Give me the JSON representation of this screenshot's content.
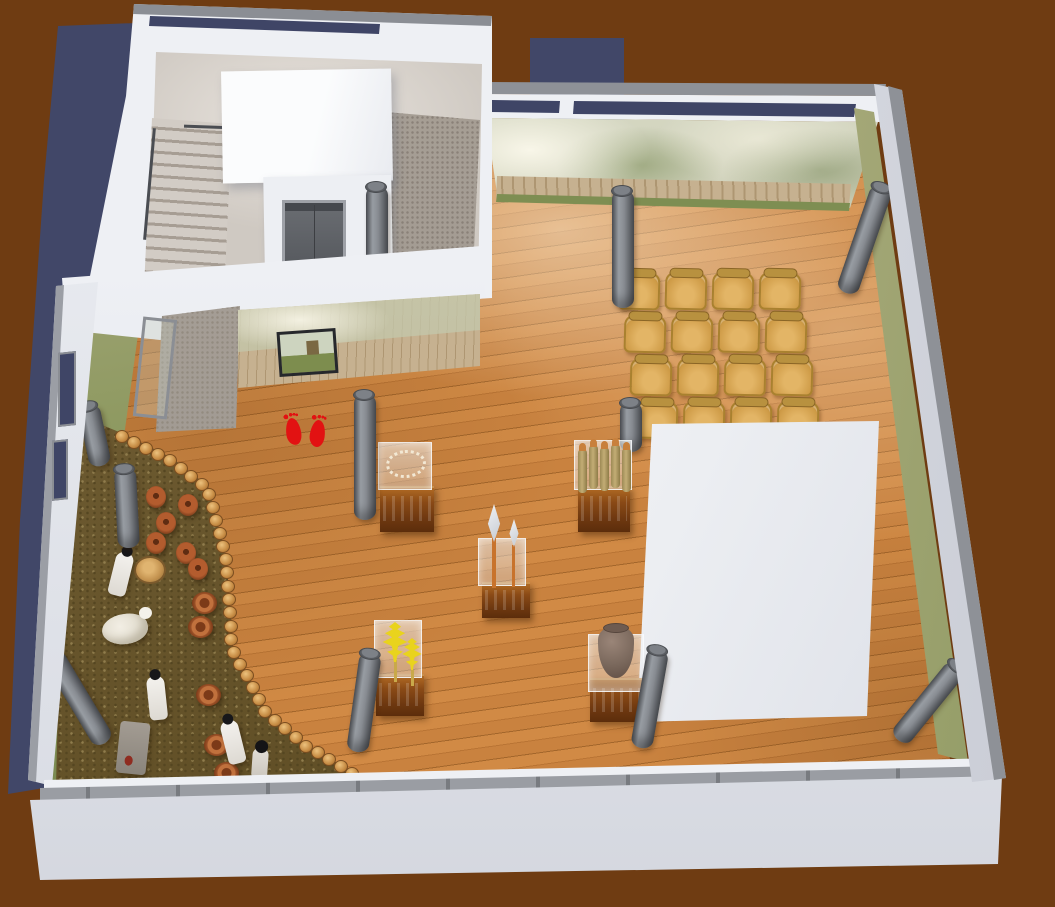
{
  "meta": {
    "title": "Museum exhibition hall — 3D cutaway visualization",
    "canvas_width": 1055,
    "canvas_height": 907,
    "view": "axonometric cutaway (dollhouse) rendering"
  },
  "palette": {
    "backdrop": "#6F3C12",
    "backdrop_shadow": "#414768",
    "wall_white": "#EEF0F4",
    "wall_cap_gray": "#8E9197",
    "clerestory_navy": "#3F4566",
    "wood_floor": "#C9823F",
    "wood_seam": "#A3662B",
    "mural_green": "#7C8C52",
    "mural_tan": "#C3C2A6",
    "dirt": "#6B5A34",
    "terracotta": "#B35C2E",
    "column_gray": "#84888E",
    "chair_wood": "#CF9C48",
    "marker_red": "#E21212",
    "wheat_yellow": "#E9D31D",
    "pedestal_wood": "#8A4A16"
  },
  "rooms": [
    {
      "id": "stairwell-block",
      "label": "Stairwell and elevator lobby"
    },
    {
      "id": "main-hall",
      "label": "Main exhibition hall with wood plank floor"
    },
    {
      "id": "diorama",
      "label": "Settlement diorama on dirt floor"
    }
  ],
  "features": {
    "stairs": {
      "label": "Staircase with handrail"
    },
    "elevator": {
      "label": "Elevator with gray doors"
    },
    "roof_cube": {
      "label": "White volume above stair core"
    },
    "canopy": {
      "label": "White entrance canopy"
    },
    "entry_path": {
      "label": "Stone entry landing"
    },
    "glass_door": {
      "label": "Open glass entrance door"
    },
    "video_screen": {
      "label": "Wall-mounted video screen",
      "content": "grassland settlement footage"
    },
    "entrance_marker": {
      "label": "Red footprint start marker",
      "count": 2
    },
    "murals": {
      "label": "Photographic wall murals",
      "theme": "forest, wooden palisade fence, grassland"
    },
    "big_display_volume": {
      "label": "Large white display volume"
    },
    "colonnade": {
      "label": "Gray cylindrical columns, several toppled/leaning",
      "count": 10
    },
    "pottery_border": {
      "label": "Curved border of round pottery discs",
      "count": 34
    }
  },
  "seating": {
    "label": "Audience chairs",
    "rows": 4,
    "cols": 4,
    "total": 16
  },
  "exhibits": [
    {
      "id": "necklace-display",
      "label": "Bead necklace in acrylic case on wooden pedestal"
    },
    {
      "id": "spears-display",
      "label": "Two spears in acrylic case on wooden pedestal"
    },
    {
      "id": "wheat-display",
      "label": "Wheat sheaves in acrylic case on wooden pedestal"
    },
    {
      "id": "stakes-display",
      "label": "Bundle of five wooden stakes on wooden pedestal"
    },
    {
      "id": "urn-display",
      "label": "Clay urn in acrylic case on wooden pedestal"
    }
  ],
  "diorama_contents": {
    "jars": 6,
    "bowls": 5,
    "stump": 1,
    "sheep": 1,
    "people": 5,
    "label": "Figures tending animals and pottery on dirt ground"
  },
  "collections": {
    "columns_behind": [
      [
        620,
        402,
        50,
        0
      ]
    ],
    "columns": [
      [
        612,
        190,
        118,
        0
      ],
      [
        354,
        394,
        126,
        0
      ],
      [
        835,
        181,
        112,
        19
      ],
      [
        887,
        645,
        95,
        39
      ],
      [
        346,
        652,
        100,
        8
      ],
      [
        630,
        648,
        100,
        10
      ],
      [
        94,
        638,
        105,
        -31
      ],
      [
        90,
        404,
        62,
        -12
      ],
      [
        118,
        468,
        80,
        -3
      ]
    ],
    "arc_dots": {
      "count": 34,
      "path": [
        [
          122,
          436
        ],
        [
          170,
          460
        ],
        [
          207,
          487
        ],
        [
          226,
          556
        ],
        [
          232,
          648
        ],
        [
          266,
          712
        ],
        [
          305,
          745
        ],
        [
          352,
          773
        ]
      ]
    },
    "jars": [
      [
        146,
        486
      ],
      [
        178,
        494
      ],
      [
        156,
        512
      ],
      [
        146,
        532
      ],
      [
        176,
        542
      ],
      [
        188,
        558
      ]
    ],
    "bowls": [
      [
        192,
        592
      ],
      [
        188,
        616
      ],
      [
        196,
        684
      ],
      [
        204,
        734
      ],
      [
        214,
        762
      ]
    ],
    "stump": [
      134,
      556
    ],
    "stakes_offsets": [
      [
        0,
        5
      ],
      [
        11,
        1
      ],
      [
        22,
        3
      ],
      [
        33,
        0
      ],
      [
        44,
        4
      ]
    ],
    "figures": [
      {
        "type": "person",
        "x": 112,
        "y": 552,
        "rot": 14
      },
      {
        "type": "sheep",
        "x": 102,
        "y": 614,
        "rot": -8
      },
      {
        "type": "person",
        "x": 148,
        "y": 676,
        "rot": -6
      },
      {
        "type": "loom",
        "x": 118,
        "y": 722,
        "rot": 6
      },
      {
        "type": "person",
        "x": 224,
        "y": 720,
        "rot": -14
      },
      {
        "type": "child",
        "x": 252,
        "y": 748,
        "rot": 4
      }
    ]
  }
}
